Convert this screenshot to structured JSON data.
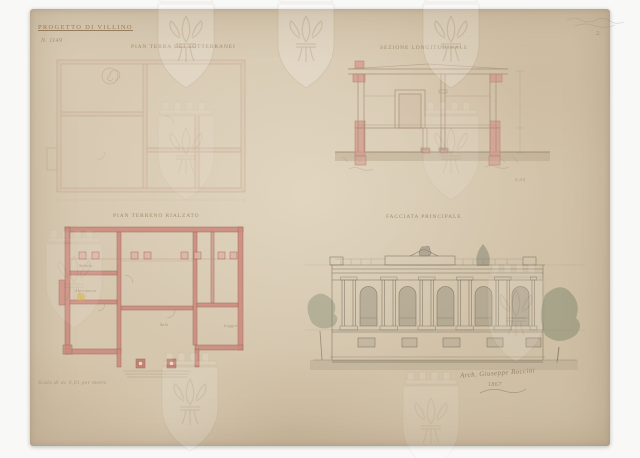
{
  "document": {
    "title": "PROGETTO DI VILLINO",
    "file_number": "N. 1149",
    "corner_note": "2.",
    "scale_note": "Scala di m. 0,01 per metro",
    "signature": "Arch. Giuseppe Boccini",
    "signature_date": "1867",
    "dimension_note": "6,04"
  },
  "drawings": {
    "basement_plan": {
      "label": "PIAN TERRA DEI SOTTERRANEI"
    },
    "section": {
      "label": "SEZIONE LONGITUDINALE"
    },
    "ground_floor_plan": {
      "label": "PIAN TERRENO RIALZATO",
      "rooms": [
        "Salotto",
        "Anticamera",
        "Sala",
        "Loggia"
      ]
    },
    "elevation": {
      "label": "FACCIATA PRINCIPALE"
    }
  },
  "watermark": {
    "name": "florentine-lily-shield"
  },
  "colors": {
    "paper": "#d3c4ab",
    "wall_pink": "#cb8a7d",
    "ink_brown": "#9a8066",
    "wash_grey": "#8b8375",
    "stain_yellow": "#d7b03e"
  }
}
